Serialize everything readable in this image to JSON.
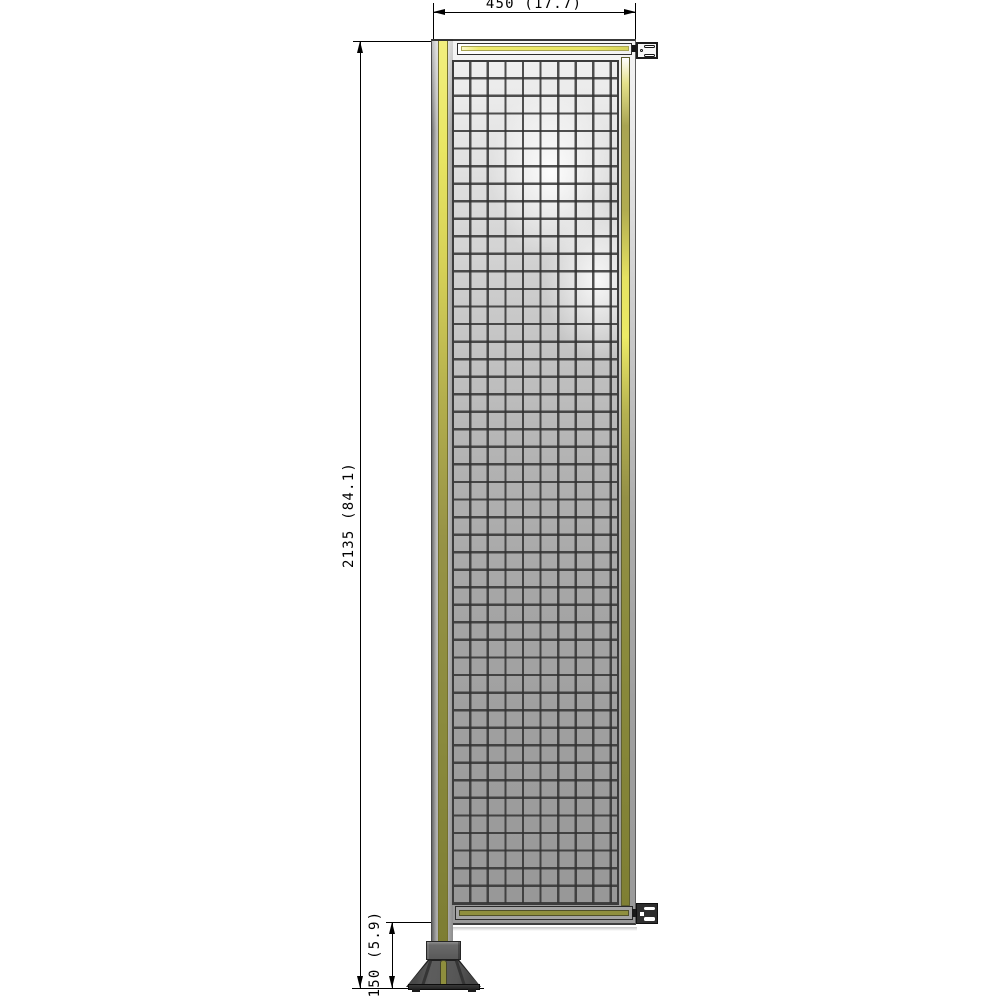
{
  "dimensions": {
    "width": "450 (17.7)",
    "height": "2135 (84.1)",
    "foot_height": "150 (5.9)"
  },
  "colors": {
    "accent_yellow": "#e9e662",
    "accent_olive": "#8c8c3f",
    "frame_gray": "#b5b5b5",
    "foot_dark_gray": "#565656",
    "dimension_line": "#000000"
  }
}
